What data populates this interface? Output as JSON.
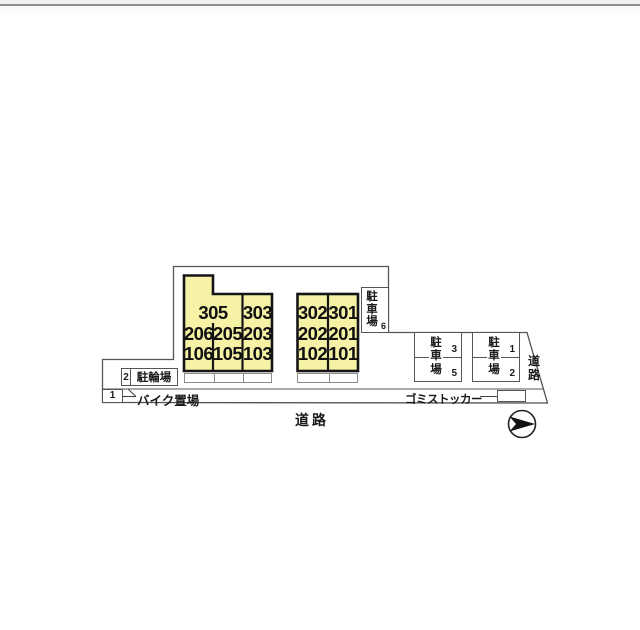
{
  "site_plan": {
    "buildings": {
      "left": {
        "rows": [
          [
            "305",
            "303"
          ],
          [
            "206",
            "205",
            "203"
          ],
          [
            "106",
            "105",
            "103"
          ]
        ]
      },
      "right": {
        "rows": [
          [
            "302",
            "301"
          ],
          [
            "202",
            "201"
          ],
          [
            "102",
            "101"
          ]
        ]
      }
    },
    "parking_stall_6": {
      "label": "駐車場",
      "number": "6"
    },
    "parking_lots": [
      {
        "label": "駐車場",
        "stall_top": "3",
        "stall_bottom": "5"
      },
      {
        "label": "駐車場",
        "stall_top": "1",
        "stall_bottom": "2"
      }
    ],
    "bicycle_parking": {
      "number": "2",
      "label": "駐輪場"
    },
    "motorcycle_parking": {
      "number": "1",
      "label": "バイク置場"
    },
    "garbage_storage": {
      "label": "ゴミストッカー"
    },
    "road_right": "道路",
    "road_bottom": "道路",
    "colors": {
      "unit_fill": "#f5f1a5",
      "wall": "#1a1a1a",
      "boundary": "#555555"
    }
  }
}
